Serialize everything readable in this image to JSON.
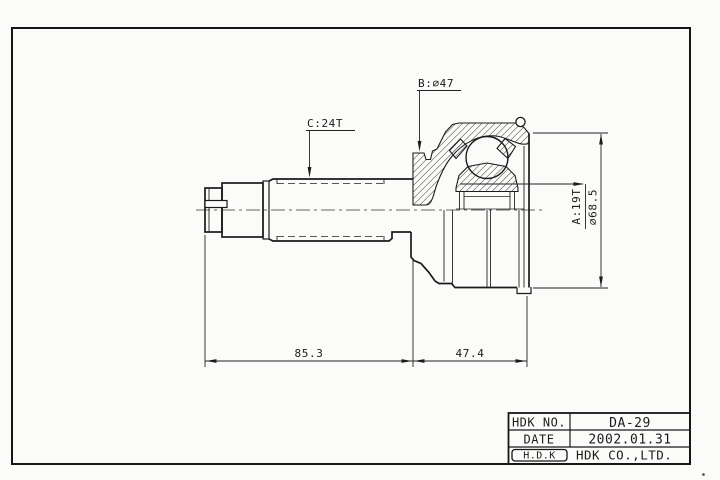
{
  "page": {
    "background": "#fbfbf9",
    "line_color": "#1b1b1b"
  },
  "drawing": {
    "part_type": "cv-joint-outer-race-technical-drawing",
    "dimension_labels": {
      "spline_b": "B:∅47",
      "spline_c": "C:24T",
      "spline_a": "A:19T",
      "outer_diameter": "∅68.5",
      "length_left": "85.3",
      "length_right": "47.4"
    }
  },
  "title_block": {
    "rows": [
      {
        "label": "HDK NO.",
        "value": "DA-29"
      },
      {
        "label": "DATE",
        "value": "2002.01.31"
      },
      {
        "label": "H.D.K",
        "value": "HDK CO.,LTD."
      }
    ]
  }
}
